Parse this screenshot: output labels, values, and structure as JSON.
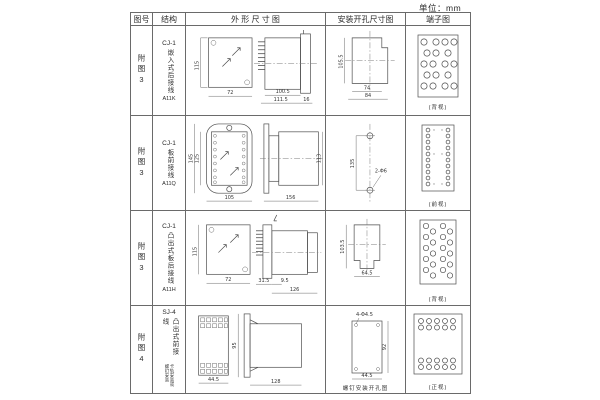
{
  "unit_label": "单位：mm",
  "header": {
    "figure_no": "图号",
    "structure": "结构",
    "outline": "外 形 尺 寸 图",
    "mounting": "安装开孔尺寸图",
    "terminal": "端子图"
  },
  "rows": [
    {
      "figure_no": "附图3",
      "model": "CJ-1",
      "desc": "嵌入式后接线",
      "code": "A11K",
      "outline": {
        "front_h": "115",
        "front_w": "72",
        "d1": "100.5",
        "d2": "111.5",
        "d3": "16"
      },
      "mounting": {
        "v": "105.5",
        "h1": "74",
        "h2": "84"
      },
      "terminal_caption": "(背视)"
    },
    {
      "figure_no": "附图3",
      "model": "CJ-1",
      "desc": "板前接线",
      "code": "A11Q",
      "outline": {
        "front_h1": "145",
        "front_h2": "125",
        "front_w": "105",
        "side_w": "156",
        "side_h": "113"
      },
      "mounting": {
        "v": "135",
        "holes": "2-Φ6"
      },
      "terminal_caption": "(前视)"
    },
    {
      "figure_no": "附图3",
      "model": "CJ-1",
      "desc": "凸出式板后接线",
      "code": "A11H",
      "outline": {
        "front_h": "115",
        "front_w": "72",
        "d1": "31.5",
        "d2": "9.5",
        "d3": "126"
      },
      "mounting": {
        "v": "103.5",
        "h": "64.5"
      },
      "terminal_caption": "(背视)"
    },
    {
      "figure_no": "附图4",
      "model": "SJ-4",
      "desc": "凸出式前接线",
      "note": "卡轨安装或螺钉安装",
      "outline": {
        "front_w": "44.5",
        "side_h": "95",
        "side_w": "128"
      },
      "mounting": {
        "holes": "4-Φ4.5",
        "v": "92",
        "h": "44.5",
        "caption": "螺钉安装开孔图"
      },
      "terminal_caption": "(正视)"
    }
  ]
}
